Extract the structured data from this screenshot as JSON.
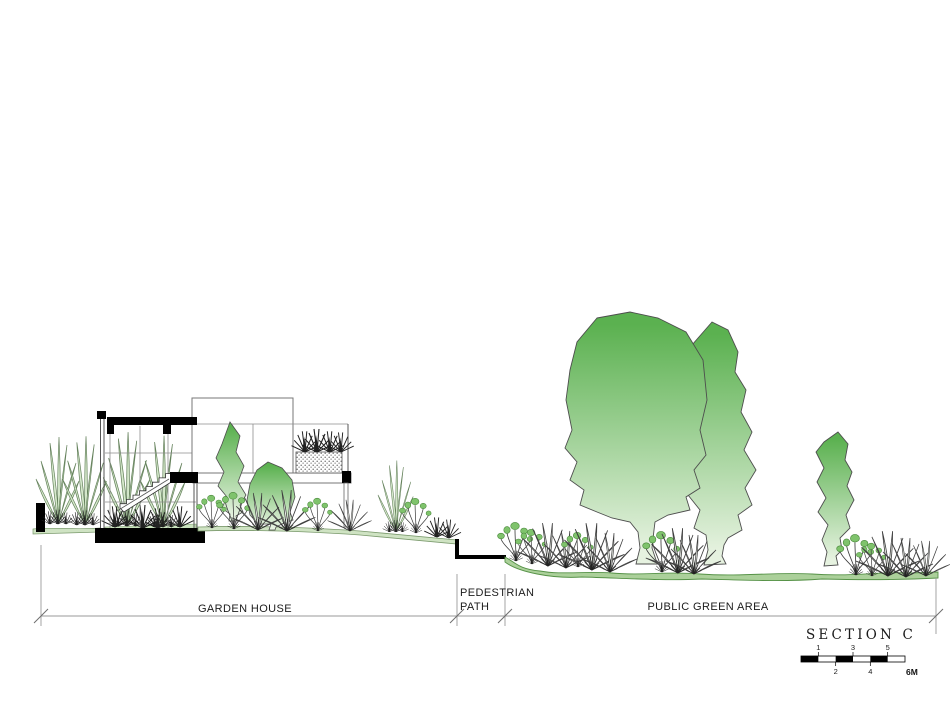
{
  "labels": {
    "garden_house": "GARDEN HOUSE",
    "pedestrian_line1": "PEDESTRIAN",
    "pedestrian_line2": "PATH",
    "public_green_area": "PUBLIC GREEN AREA",
    "section_title": "SECTION C"
  },
  "scale_bar": {
    "labels_above": [
      "1",
      "3",
      "5"
    ],
    "labels_below": [
      "2",
      "4"
    ],
    "end_label": "6M"
  },
  "colors": {
    "tree_top": "#5bb150",
    "tree_bottom": "#e6f2e0",
    "ground_fill": "#abd09a",
    "ground_stroke": "#569247",
    "leaf_fill": "#d6e9cc",
    "flower_fill": "#7fc36c",
    "cut_black": "#000000"
  }
}
